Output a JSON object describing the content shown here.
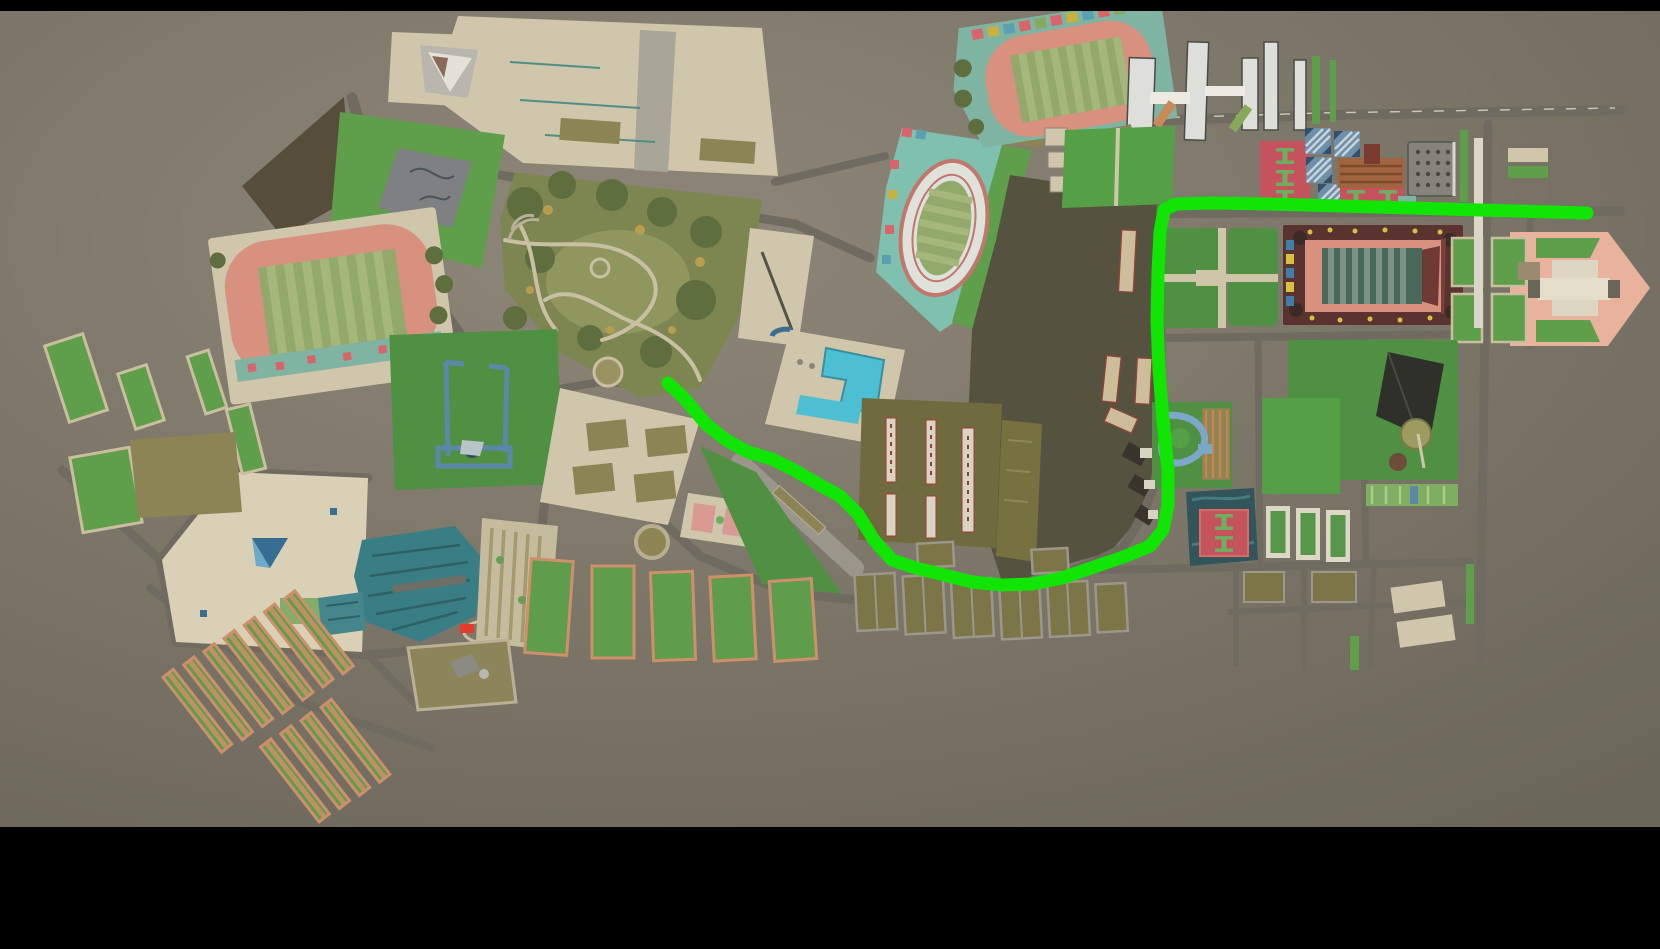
{
  "scene": {
    "name": "campus-aerial-route-map",
    "description_of_pixels": "top-down rendered campus map with bright green navigation route, black letterbox bars top and bottom",
    "map_area": {
      "top": 11,
      "bottom": 827,
      "width": 1660,
      "height": 949
    }
  },
  "palette": {
    "letterbox": "#000000",
    "ground_center": "#8e8779",
    "ground_edge": "#6b665a",
    "road": "#6f6b60",
    "road_light": "#9a968c",
    "path_beige": "#c9c0a4",
    "plaza": "#cfc6ab",
    "plaza_bright": "#d9d0b5",
    "lawn": "#5f9e4a",
    "lawn_dark": "#4f9043",
    "lawn_bright": "#55a046",
    "park_base": "#7d8551",
    "tree_dark": "#5e6e3e",
    "accent_autumn": "#b89d4e",
    "track_salmon": "#d8917f",
    "field_green": "#93a86b",
    "field_stripe": "#a6b77c",
    "stands_teal": "#7fb3a2",
    "teal_ground": "#7fc0ae",
    "pool_cyan": "#4cc0d2",
    "gym_teal": "#397e85",
    "steel_blue": "#5b87a8",
    "court_red": "#c4535e",
    "court_mark_green": "#6fae5e",
    "court_blue": "#6d8fa8",
    "court_blue_light": "#c8d4dc",
    "plot_olive": "#8c8454",
    "plot_khaki": "#7b7547",
    "garden_green": "#5f9c4c",
    "garden_salmon": "#cf8f6a",
    "strip_border": "#c9bf9f",
    "dark_ground": "#565240",
    "woods": "#564d3b",
    "gate_pink": "#e8b29c",
    "building_white": "#dedfda",
    "building_outline": "#4a4a46",
    "stadium_border": "#5a3330",
    "stadium_infield": "#49695a",
    "stadium_stripe": "#7a9383",
    "roof_brown": "#a2643e",
    "roof_brown_dark": "#7c3b30",
    "marker_red": "#e53a2e",
    "route_green": "#10e504"
  },
  "route": {
    "color_key": "route_green",
    "stroke_width": 13,
    "linecap": "round",
    "points": [
      [
        668,
        383
      ],
      [
        684,
        398
      ],
      [
        706,
        424
      ],
      [
        726,
        440
      ],
      [
        748,
        452
      ],
      [
        772,
        459
      ],
      [
        794,
        470
      ],
      [
        818,
        484
      ],
      [
        840,
        496
      ],
      [
        858,
        514
      ],
      [
        874,
        540
      ],
      [
        892,
        560
      ],
      [
        916,
        568
      ],
      [
        944,
        575
      ],
      [
        972,
        582
      ],
      [
        1002,
        585
      ],
      [
        1032,
        584
      ],
      [
        1062,
        578
      ],
      [
        1094,
        567
      ],
      [
        1126,
        556
      ],
      [
        1150,
        546
      ],
      [
        1163,
        530
      ],
      [
        1168,
        505
      ],
      [
        1168,
        470
      ],
      [
        1163,
        420
      ],
      [
        1159,
        370
      ],
      [
        1157,
        320
      ],
      [
        1158,
        272
      ],
      [
        1160,
        232
      ],
      [
        1164,
        210
      ],
      [
        1176,
        204
      ],
      [
        1210,
        203
      ],
      [
        1270,
        204
      ],
      [
        1340,
        206
      ],
      [
        1410,
        208
      ],
      [
        1480,
        210
      ],
      [
        1587,
        213
      ]
    ]
  },
  "features": [
    "west-stadium-track",
    "west-central-park",
    "skate-park",
    "velodrome-teal-area",
    "u-shaped-pool",
    "gate-frames-lawn",
    "teal-gym-hall",
    "southwest-plaza",
    "garden-strip-plots",
    "northeast-stadium-track",
    "white-tower-buildings",
    "red-basketball-courts",
    "blue-tennis-courts",
    "central-rect-stadium",
    "dark-pyramid-park",
    "east-gate-plaza",
    "greenhouse-block",
    "route-overlay"
  ]
}
